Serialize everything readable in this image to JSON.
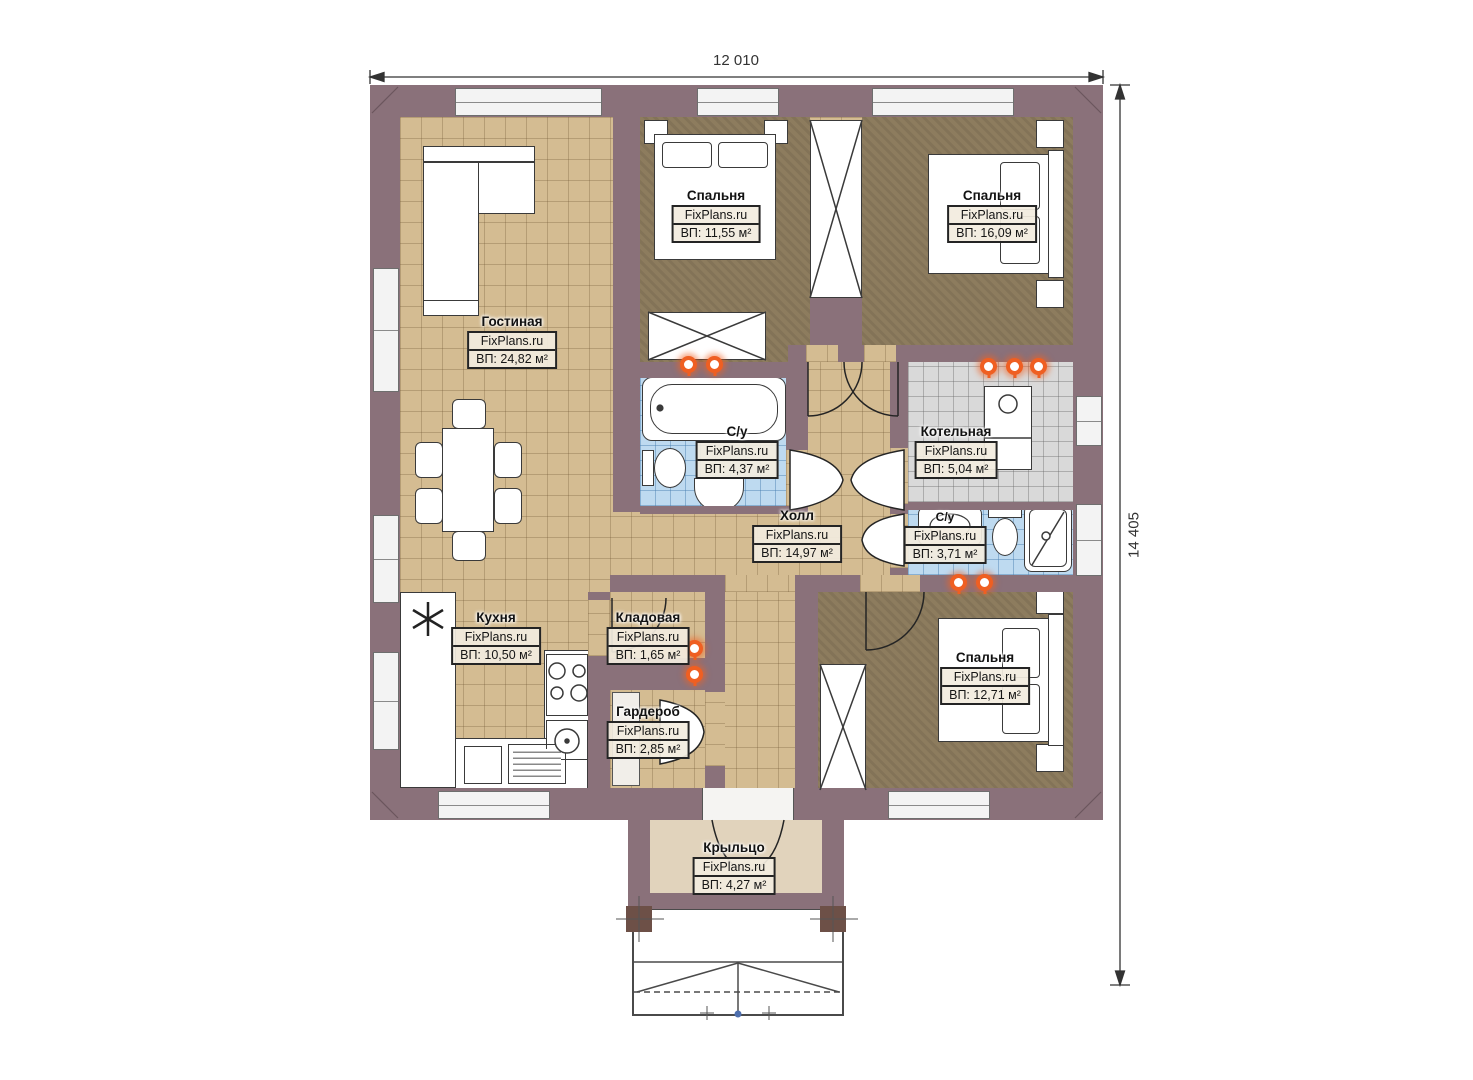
{
  "plan_title": "One-storey house floor plan",
  "dimensions": {
    "width_label": "12 010",
    "height_label": "14 405"
  },
  "rooms": [
    {
      "id": "living",
      "name": "Гостиная",
      "brand": "FixPlans.ru",
      "area": "ВП: 24,82 м²"
    },
    {
      "id": "bedroom1",
      "name": "Спальня",
      "brand": "FixPlans.ru",
      "area": "ВП: 11,55 м²"
    },
    {
      "id": "bedroom2",
      "name": "Спальня",
      "brand": "FixPlans.ru",
      "area": "ВП: 16,09 м²"
    },
    {
      "id": "bath1",
      "name": "С/у",
      "brand": "FixPlans.ru",
      "area": "ВП: 4,37 м²"
    },
    {
      "id": "boiler",
      "name": "Котельная",
      "brand": "FixPlans.ru",
      "area": "ВП: 5,04 м²"
    },
    {
      "id": "hall",
      "name": "Холл",
      "brand": "FixPlans.ru",
      "area": "ВП: 14,97 м²"
    },
    {
      "id": "bath2",
      "name": "С/у",
      "brand": "FixPlans.ru",
      "area": "ВП: 3,71 м²"
    },
    {
      "id": "kitchen",
      "name": "Кухня",
      "brand": "FixPlans.ru",
      "area": "ВП: 10,50 м²"
    },
    {
      "id": "storage",
      "name": "Кладовая",
      "brand": "FixPlans.ru",
      "area": "ВП: 1,65 м²"
    },
    {
      "id": "wardrobe",
      "name": "Гардероб",
      "brand": "FixPlans.ru",
      "area": "ВП: 2,85 м²"
    },
    {
      "id": "bedroom3",
      "name": "Спальня",
      "brand": "FixPlans.ru",
      "area": "ВП: 12,71 м²"
    },
    {
      "id": "porch",
      "name": "Крыльцо",
      "brand": "FixPlans.ru",
      "area": "ВП: 4,27 м²"
    }
  ],
  "colors": {
    "wall": "#8a717a",
    "floor_tan": "#d4bc92",
    "floor_bedroom": "#8d7c5e",
    "floor_bath": "#bedaf0",
    "floor_boiler": "#d9d9d9",
    "floor_porch": "#e1d3bc",
    "flame_accent": "#ef5f22"
  }
}
